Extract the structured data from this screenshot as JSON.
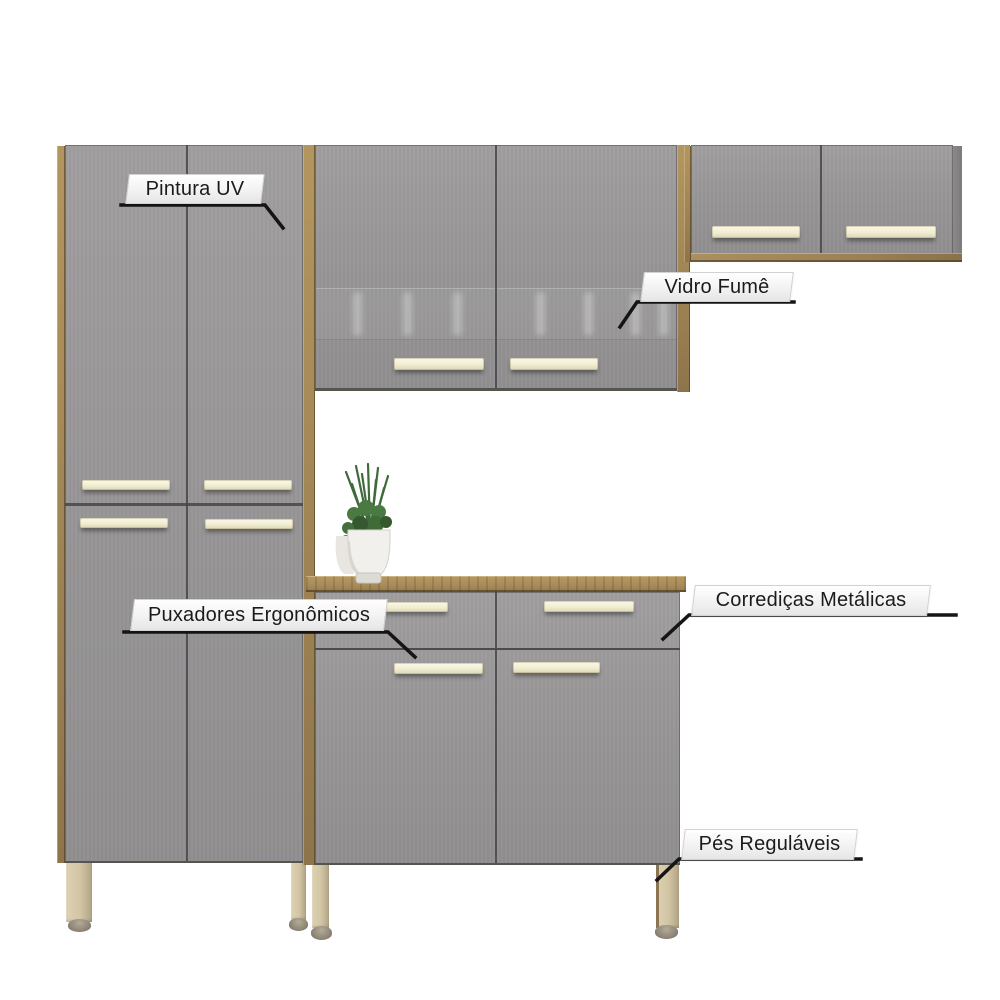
{
  "image": {
    "kind": "annotated product render",
    "scene": "modular kitchen cabinet set, gray doors with wood-finish frame, white background"
  },
  "callouts": [
    {
      "id": "pintura-uv",
      "label": "Pintura UV"
    },
    {
      "id": "vidro-fume",
      "label": "Vidro Fumê"
    },
    {
      "id": "puxadores-ergonomicos",
      "label": "Puxadores Ergonômicos"
    },
    {
      "id": "corredicas-metalicas",
      "label": "Corrediças Metálicas"
    },
    {
      "id": "pes-regulaveis",
      "label": "Pés Reguláveis"
    }
  ],
  "furniture": {
    "modules": [
      {
        "name": "tall-cabinet",
        "doors": 4,
        "handles": 4,
        "legs": 2
      },
      {
        "name": "wall-cabinet-glass",
        "doors": 2,
        "handles": 2,
        "glass": "smoked"
      },
      {
        "name": "wall-cabinet-right",
        "doors": 2,
        "handles": 2
      },
      {
        "name": "base-cabinet",
        "drawers": 2,
        "doors": 2,
        "handles": 4,
        "legs": 2,
        "countertop": true,
        "decor": "potted plant"
      }
    ]
  },
  "colors": {
    "background": "#ffffff",
    "door_gray": "#98969a",
    "wood": "#a58a58",
    "wood_dark": "#8a7148",
    "handle_cream": "#f1edd2",
    "leg_beige": "#d2c5a4",
    "callout_text": "#1b1b1b",
    "leader_line": "#151515"
  }
}
